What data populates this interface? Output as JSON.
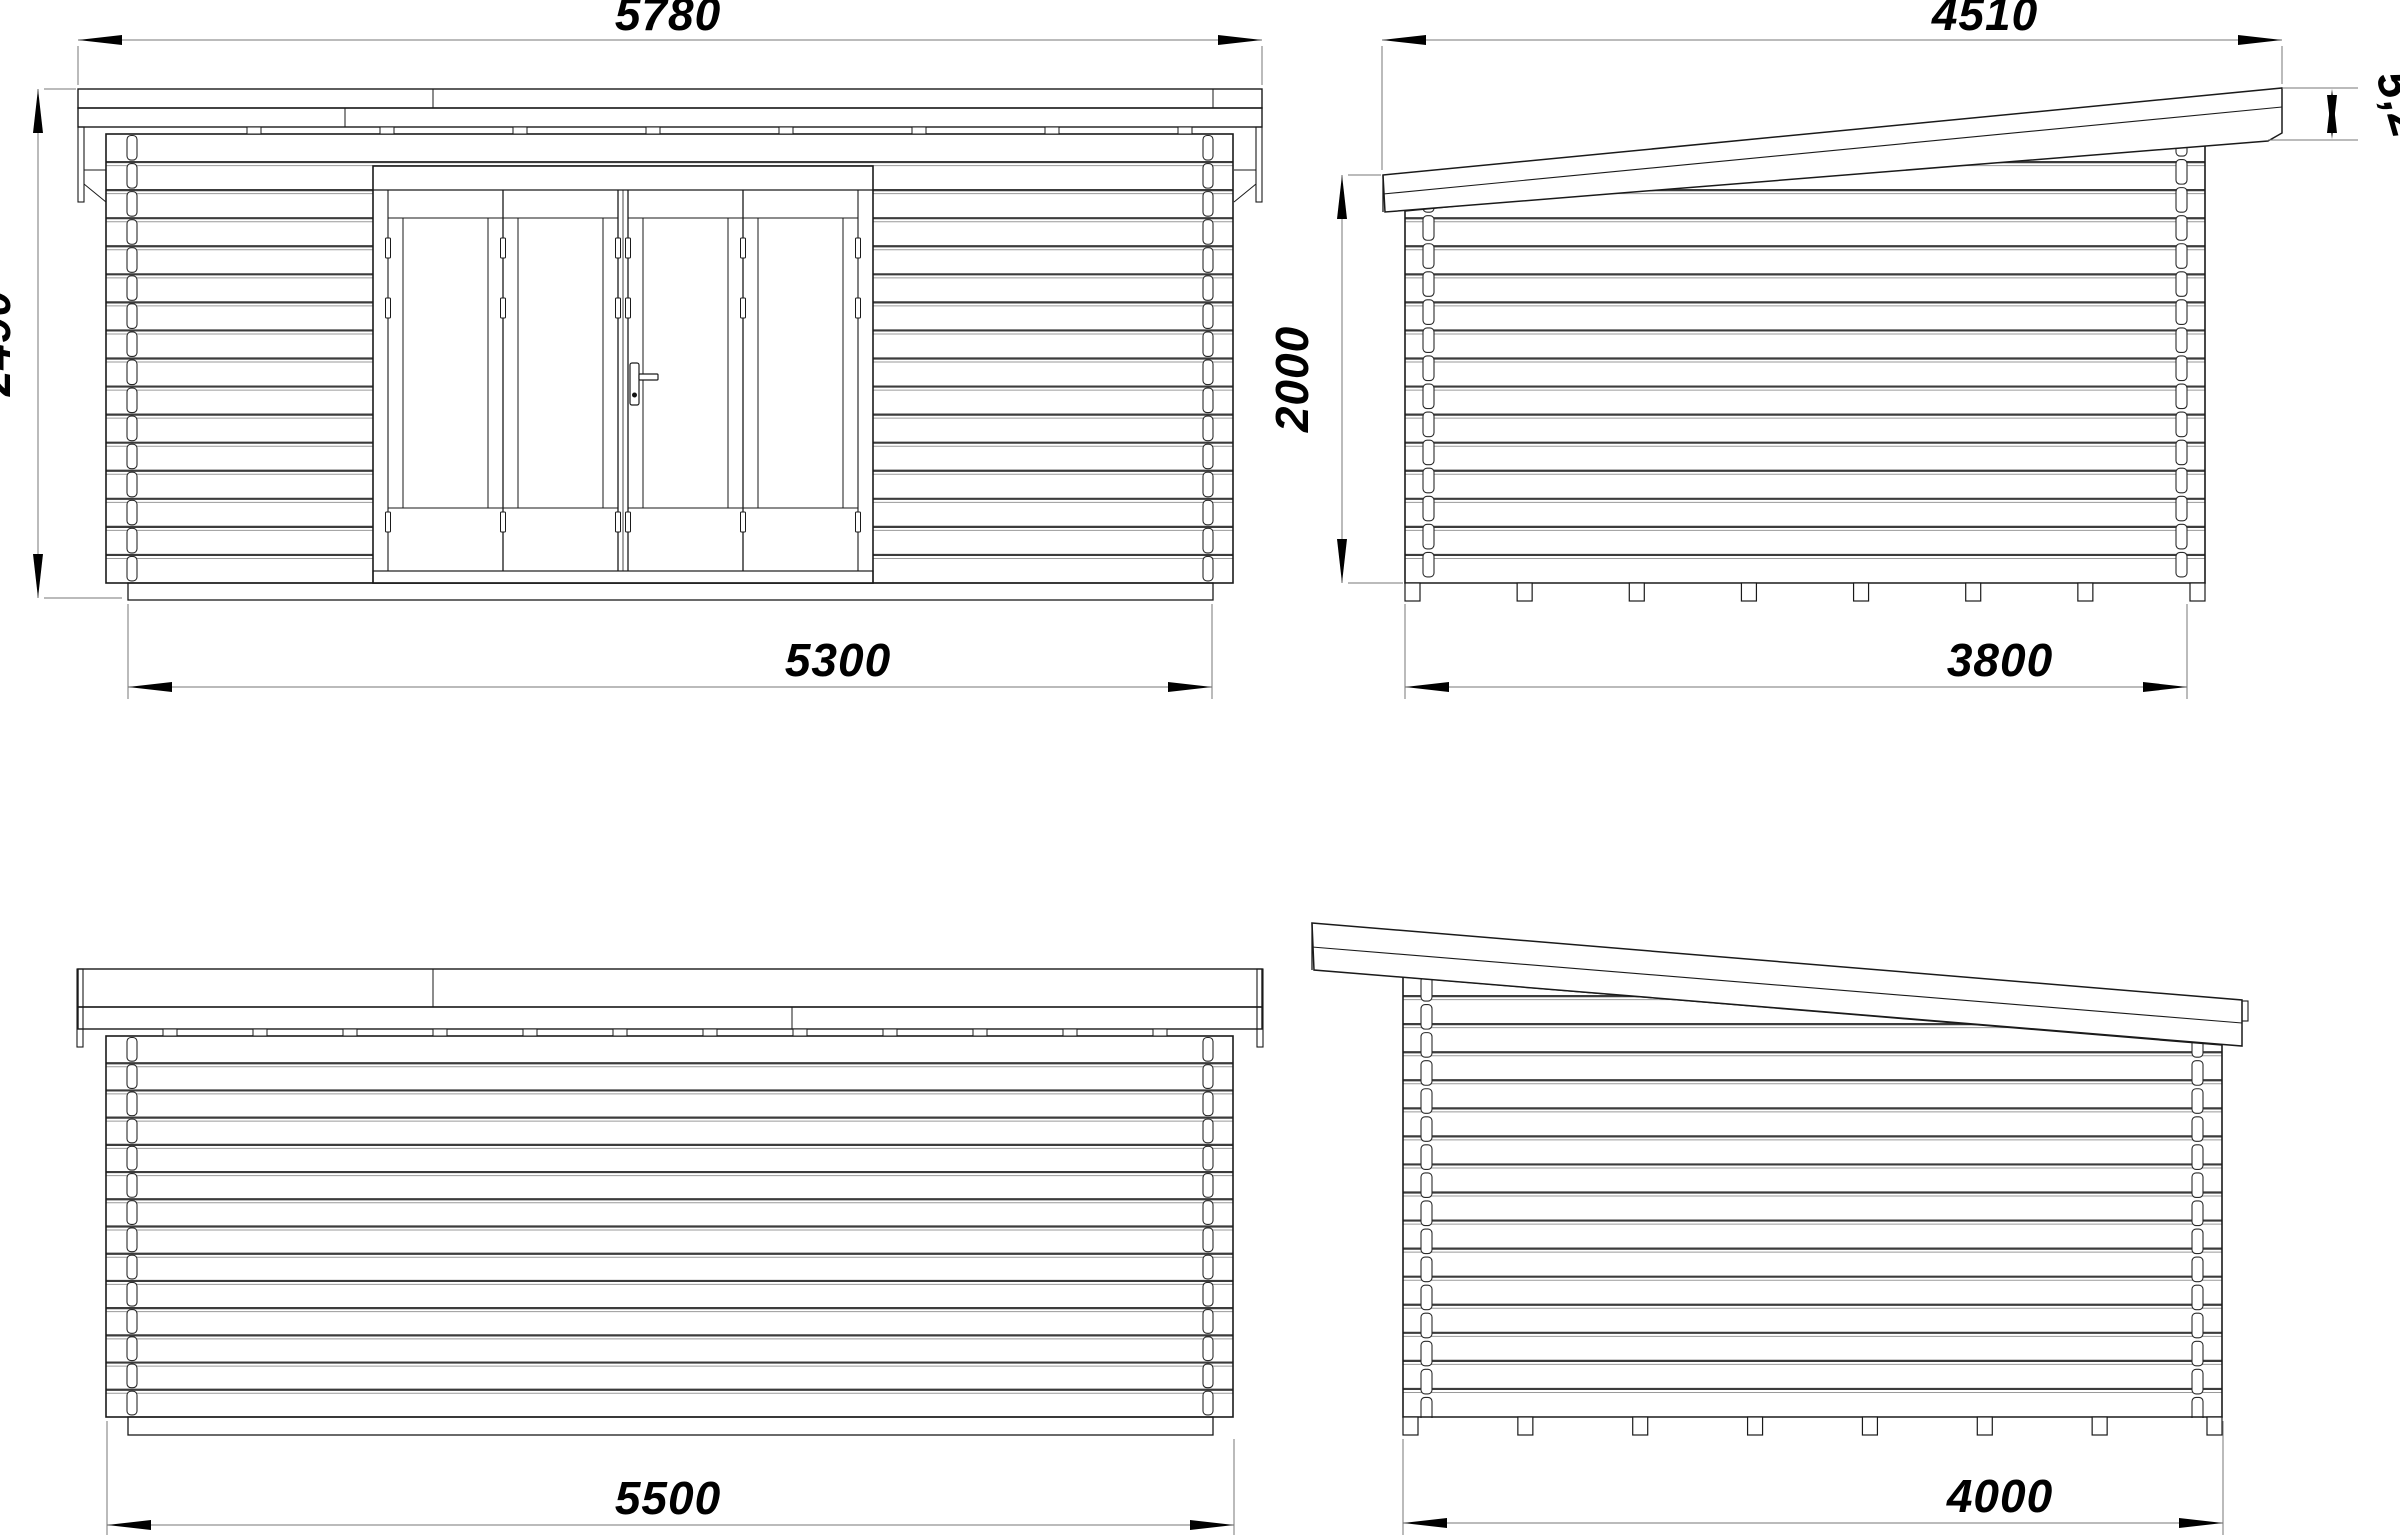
{
  "drawing": {
    "background": "#ffffff",
    "line_color": "#1a1a1a",
    "dimension_color": "#777777",
    "views": {
      "front": {
        "title": "front-elevation",
        "dims": {
          "roof_width": "5780",
          "wall_height": "2490",
          "wall_width": "5300"
        }
      },
      "side_right": {
        "title": "right-side-elevation",
        "dims": {
          "roof_length": "4510",
          "roof_angle": "5,2°",
          "eave_height": "2000",
          "wall_depth": "3800"
        }
      },
      "back": {
        "title": "back-elevation",
        "dims": {
          "overall_width": "5500"
        }
      },
      "side_left": {
        "title": "left-side-elevation",
        "dims": {
          "overall_depth": "4000"
        }
      }
    }
  }
}
